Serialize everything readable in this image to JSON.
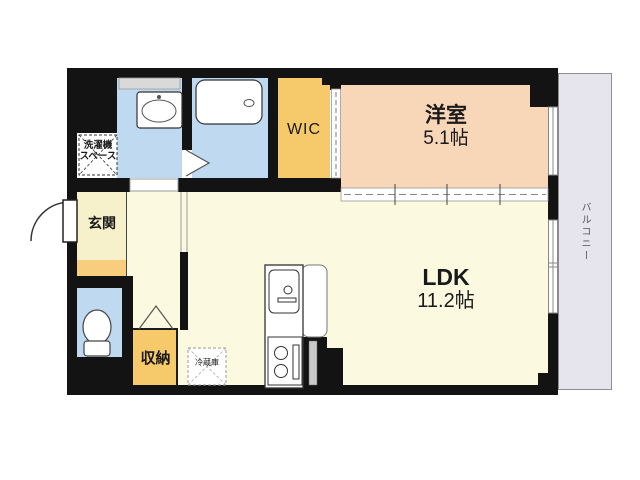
{
  "floorplan": {
    "title": "1LDK apartment floor plan",
    "rooms": {
      "yoshitsu": {
        "name": "洋室",
        "size": "5.1帖"
      },
      "ldk": {
        "name": "LDK",
        "size": "11.2帖"
      },
      "wic_label": "WIC",
      "genkan_label": "玄関",
      "storage_label": "収納",
      "laundry_line1": "洗濯機",
      "laundry_line2": "スペース",
      "refrigerator_label": "冷蔵庫",
      "balcony_label": "バルコニー"
    },
    "colors": {
      "wall": "#131313",
      "room_pink": "#F8D6B8",
      "room_cream": "#FBFAE1",
      "genkan_cream": "#F7F1CB",
      "accent_orange": "#F6C96B",
      "step_orange": "#F8CE7E",
      "water_blue": "#BFD9F1",
      "balcony_gray": "#E6E4EC",
      "window_gray": "#D9D9D9"
    }
  }
}
